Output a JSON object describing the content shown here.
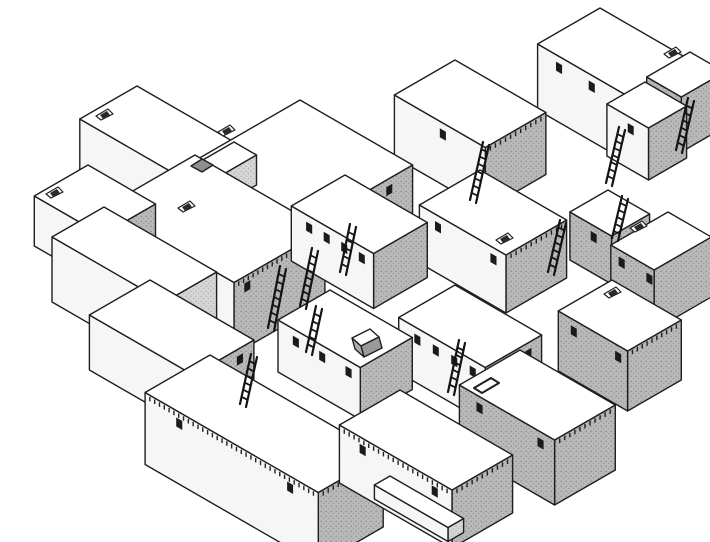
{
  "figure": {
    "kind": "axonometric-line-drawing",
    "subject": "dense-cluster-of-flat-roofed-houses-with-roof-ladders"
  },
  "scene": {
    "canvas": {
      "w": 710,
      "h": 542
    },
    "colors": {
      "background": "#ffffff",
      "outline": "#1f1f1f",
      "roof": "#ffffff",
      "wall_white": "#f6f6f6",
      "gray_base": "#b9b9b9",
      "gray_dot1": "#8f8f8f",
      "gray_dot2": "#9a9a9a",
      "light_base": "#d6d6d6",
      "light_dot": "#b5b5b5",
      "window": "#1b1b1b",
      "ladder": "#141414",
      "dentil": "#222222",
      "notch": "#8f8f8f",
      "doghouse_front": "#9a9a9a",
      "doghouse_side": "#ababab"
    },
    "buildings": [
      {
        "id": "house-top-left",
        "n": [
          137,
          86
        ],
        "w": 112,
        "d": 66,
        "h": 58,
        "right": {
          "fill": "gray",
          "windows": 4,
          "dentil": false
        },
        "left": {
          "fill": "white",
          "windows": 0,
          "dentil": false
        }
      },
      {
        "id": "terrace-top-left",
        "n": [
          234,
          142
        ],
        "w": 26,
        "d": 66,
        "h": 30,
        "right": {
          "fill": "light",
          "windows": 0,
          "dentil": false
        },
        "left": {
          "fill": "white",
          "windows": 0,
          "dentil": false
        }
      },
      {
        "id": "house-top-right",
        "n": [
          600,
          8
        ],
        "w": 118,
        "d": 72,
        "h": 66,
        "right": {
          "fill": "gray",
          "windows": 0,
          "dentil": true
        },
        "left": {
          "fill": "white",
          "windows": 3,
          "dentil": false
        }
      },
      {
        "id": "house-back-center",
        "n": [
          455,
          60
        ],
        "w": 105,
        "d": 70,
        "h": 62,
        "right": {
          "fill": "gray",
          "windows": 0,
          "dentil": true
        },
        "left": {
          "fill": "white",
          "windows": 1,
          "dentil": false
        }
      },
      {
        "id": "house-far-right-back",
        "n": [
          690,
          52
        ],
        "w": 40,
        "d": 50,
        "h": 55,
        "right": {
          "fill": "gray",
          "windows": 0,
          "dentil": false
        },
        "left": {
          "fill": "gray",
          "windows": 1,
          "dentil": false
        }
      },
      {
        "id": "house-right-small-back",
        "n": [
          645,
          82
        ],
        "w": 48,
        "d": 44,
        "h": 52,
        "right": {
          "fill": "gray",
          "windows": 0,
          "dentil": false
        },
        "left": {
          "fill": "white",
          "windows": 1,
          "dentil": false
        }
      },
      {
        "id": "house-big-central",
        "n": [
          300,
          100
        ],
        "w": 130,
        "d": 130,
        "h": 48,
        "right": {
          "fill": "gray",
          "windows": 5,
          "dentil": false
        },
        "left": {
          "fill": "white",
          "windows": 0,
          "dentil": false
        }
      },
      {
        "id": "house-left-chimney",
        "n": [
          88,
          165
        ],
        "w": 78,
        "d": 62,
        "h": 50,
        "right": {
          "fill": "gray",
          "windows": 0,
          "dentil": false
        },
        "left": {
          "fill": "white",
          "windows": 0,
          "dentil": false
        }
      },
      {
        "id": "house-central-left",
        "n": [
          195,
          155
        ],
        "w": 150,
        "d": 105,
        "h": 72,
        "right": {
          "fill": "gray",
          "windows": 2,
          "dentil": true
        },
        "left": {
          "fill": "white",
          "windows": 0,
          "dentil": false
        }
      },
      {
        "id": "terrace-left",
        "n": [
          104,
          207
        ],
        "w": 130,
        "d": 60,
        "h": 65,
        "right": {
          "fill": "light",
          "windows": 0,
          "dentil": false
        },
        "left": {
          "fill": "white",
          "windows": 0,
          "dentil": false
        }
      },
      {
        "id": "house-center",
        "n": [
          345,
          175
        ],
        "w": 95,
        "d": 62,
        "h": 55,
        "right": {
          "fill": "gray",
          "windows": 0,
          "dentil": false
        },
        "left": {
          "fill": "white",
          "windows": 4,
          "dentil": false
        }
      },
      {
        "id": "house-center-right",
        "n": [
          480,
          170
        ],
        "w": 100,
        "d": 70,
        "h": 58,
        "right": {
          "fill": "gray",
          "windows": 0,
          "dentil": true
        },
        "left": {
          "fill": "white",
          "windows": 2,
          "dentil": false
        }
      },
      {
        "id": "house-right-small",
        "n": [
          608,
          190
        ],
        "w": 48,
        "d": 44,
        "h": 48,
        "right": {
          "fill": "gray",
          "windows": 0,
          "dentil": false
        },
        "left": {
          "fill": "gray",
          "windows": 1,
          "dentil": false
        }
      },
      {
        "id": "house-right-edge",
        "n": [
          668,
          212
        ],
        "w": 50,
        "d": 66,
        "h": 60,
        "right": {
          "fill": "gray",
          "windows": 0,
          "dentil": false
        },
        "left": {
          "fill": "gray",
          "windows": 2,
          "dentil": false
        }
      },
      {
        "id": "house-mid-left",
        "n": [
          150,
          280
        ],
        "w": 120,
        "d": 70,
        "h": 55,
        "right": {
          "fill": "gray",
          "windows": 2,
          "dentil": false
        },
        "left": {
          "fill": "white",
          "windows": 0,
          "dentil": false
        }
      },
      {
        "id": "house-mid-center",
        "n": [
          330,
          290
        ],
        "w": 95,
        "d": 60,
        "h": 52,
        "right": {
          "fill": "gray",
          "windows": 0,
          "dentil": false
        },
        "left": {
          "fill": "white",
          "windows": 3,
          "dentil": false
        }
      },
      {
        "id": "house-mid-center-right",
        "n": [
          455,
          285
        ],
        "w": 100,
        "d": 65,
        "h": 55,
        "right": {
          "fill": "gray",
          "windows": 2,
          "dentil": false
        },
        "left": {
          "fill": "white",
          "windows": 4,
          "dentil": false
        }
      },
      {
        "id": "house-right-mid",
        "n": [
          612,
          280
        ],
        "w": 80,
        "d": 62,
        "h": 60,
        "right": {
          "fill": "gray",
          "windows": 0,
          "dentil": true
        },
        "left": {
          "fill": "gray",
          "windows": 2,
          "dentil": false
        }
      },
      {
        "id": "house-front-right",
        "n": [
          520,
          350
        ],
        "w": 110,
        "d": 70,
        "h": 65,
        "right": {
          "fill": "gray",
          "windows": 0,
          "dentil": true
        },
        "left": {
          "fill": "gray",
          "windows": 2,
          "dentil": false
        }
      },
      {
        "id": "house-front-left",
        "n": [
          210,
          355
        ],
        "w": 200,
        "d": 75,
        "h": 72,
        "right": {
          "fill": "gray",
          "windows": 0,
          "dentil": true
        },
        "left": {
          "fill": "white",
          "windows": 2,
          "dentil": true
        }
      },
      {
        "id": "house-front-center",
        "n": [
          400,
          390
        ],
        "w": 130,
        "d": 70,
        "h": 58,
        "right": {
          "fill": "gray",
          "windows": 0,
          "dentil": true
        },
        "left": {
          "fill": "white",
          "windows": 2,
          "dentil": true
        }
      },
      {
        "id": "bench-front",
        "n": [
          390,
          476
        ],
        "w": 85,
        "d": 18,
        "h": 14,
        "right": {
          "fill": "light",
          "windows": 0,
          "dentil": false
        },
        "left": {
          "fill": "white",
          "windows": 0,
          "dentil": false
        }
      }
    ],
    "ladders": [
      {
        "x": 470,
        "y": 200,
        "len": 58,
        "dx": 13
      },
      {
        "x": 606,
        "y": 183,
        "len": 56,
        "dx": 13
      },
      {
        "x": 268,
        "y": 328,
        "len": 62,
        "dx": 12
      },
      {
        "x": 300,
        "y": 306,
        "len": 58,
        "dx": 12
      },
      {
        "x": 306,
        "y": 352,
        "len": 46,
        "dx": 10
      },
      {
        "x": 448,
        "y": 392,
        "len": 52,
        "dx": 11
      },
      {
        "x": 548,
        "y": 272,
        "len": 52,
        "dx": 12
      },
      {
        "x": 240,
        "y": 404,
        "len": 50,
        "dx": 11
      },
      {
        "x": 676,
        "y": 150,
        "len": 52,
        "dx": 12
      },
      {
        "x": 612,
        "y": 238,
        "len": 42,
        "dx": 10
      },
      {
        "x": 340,
        "y": 272,
        "len": 48,
        "dx": 10
      }
    ],
    "vents": [
      {
        "x": 96,
        "y": 116
      },
      {
        "x": 218,
        "y": 132
      },
      {
        "x": 46,
        "y": 194
      },
      {
        "x": 178,
        "y": 208
      },
      {
        "x": 664,
        "y": 54
      },
      {
        "x": 496,
        "y": 240
      },
      {
        "x": 630,
        "y": 228
      },
      {
        "x": 604,
        "y": 294
      }
    ],
    "hatches": [
      {
        "type": "open",
        "x": 474,
        "y": 388
      },
      {
        "type": "notch",
        "x": 191,
        "y": 166
      },
      {
        "type": "doghouse",
        "x": 352,
        "y": 338
      }
    ]
  }
}
